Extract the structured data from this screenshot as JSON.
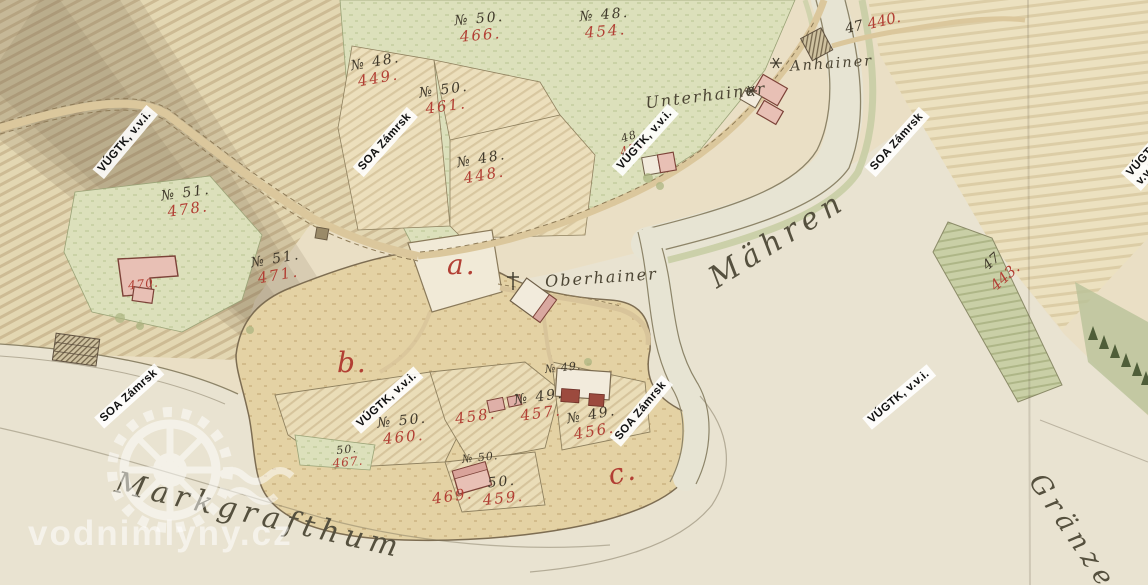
{
  "labels": {
    "territories": [
      {
        "text": "Mähren"
      },
      {
        "text": "Markgrafthum"
      },
      {
        "text": "Gränze"
      }
    ],
    "places": [
      {
        "text": "Unterhainer"
      },
      {
        "text": "Oberhainer"
      },
      {
        "text": "Anhainer"
      }
    ],
    "sections": [
      {
        "text": "a."
      },
      {
        "text": "b."
      },
      {
        "text": "c."
      }
    ],
    "parcels": [
      {
        "no": "№ 50.",
        "num": "466."
      },
      {
        "no": "№ 48.",
        "num": "454."
      },
      {
        "no": "№ 48.",
        "num": "449."
      },
      {
        "no": "№ 50.",
        "num": "461."
      },
      {
        "no": "№ 48.",
        "num": "448."
      },
      {
        "no": "№ 51.",
        "num": "478."
      },
      {
        "no": "№ 51.",
        "num": "471."
      },
      {
        "no": "№ 50.",
        "num": "460."
      },
      {
        "no": "",
        "num": "458."
      },
      {
        "no": "№ 49.",
        "num": "457."
      },
      {
        "no": "№ 49.",
        "num": "456."
      },
      {
        "no": "50.",
        "num": "459."
      },
      {
        "no": "",
        "num": "469."
      },
      {
        "no": "50.",
        "num": "467."
      },
      {
        "no": "48.",
        "num": "455."
      },
      {
        "no": "№ 50.",
        "num": ""
      },
      {
        "no": "№ 49.",
        "num": ""
      },
      {
        "no": "",
        "num": "470."
      }
    ],
    "border_marks": [
      {
        "black": "47",
        "red": "440."
      },
      {
        "black": "47",
        "red": "443."
      }
    ]
  },
  "watermarks": {
    "archive": "SOA Zámrsk",
    "institute": "VÚGTK, v.v.i.",
    "site": "vodnimlyny.cz"
  },
  "colors": {
    "paper": "#eadfc5",
    "red_ink": "#b23f34",
    "black_ink": "#40392b",
    "green_meadow": "#dce0bb",
    "water": "#e9e3d1",
    "building_pink": "#e8c0b5",
    "building_red": "#9c4a3e"
  }
}
